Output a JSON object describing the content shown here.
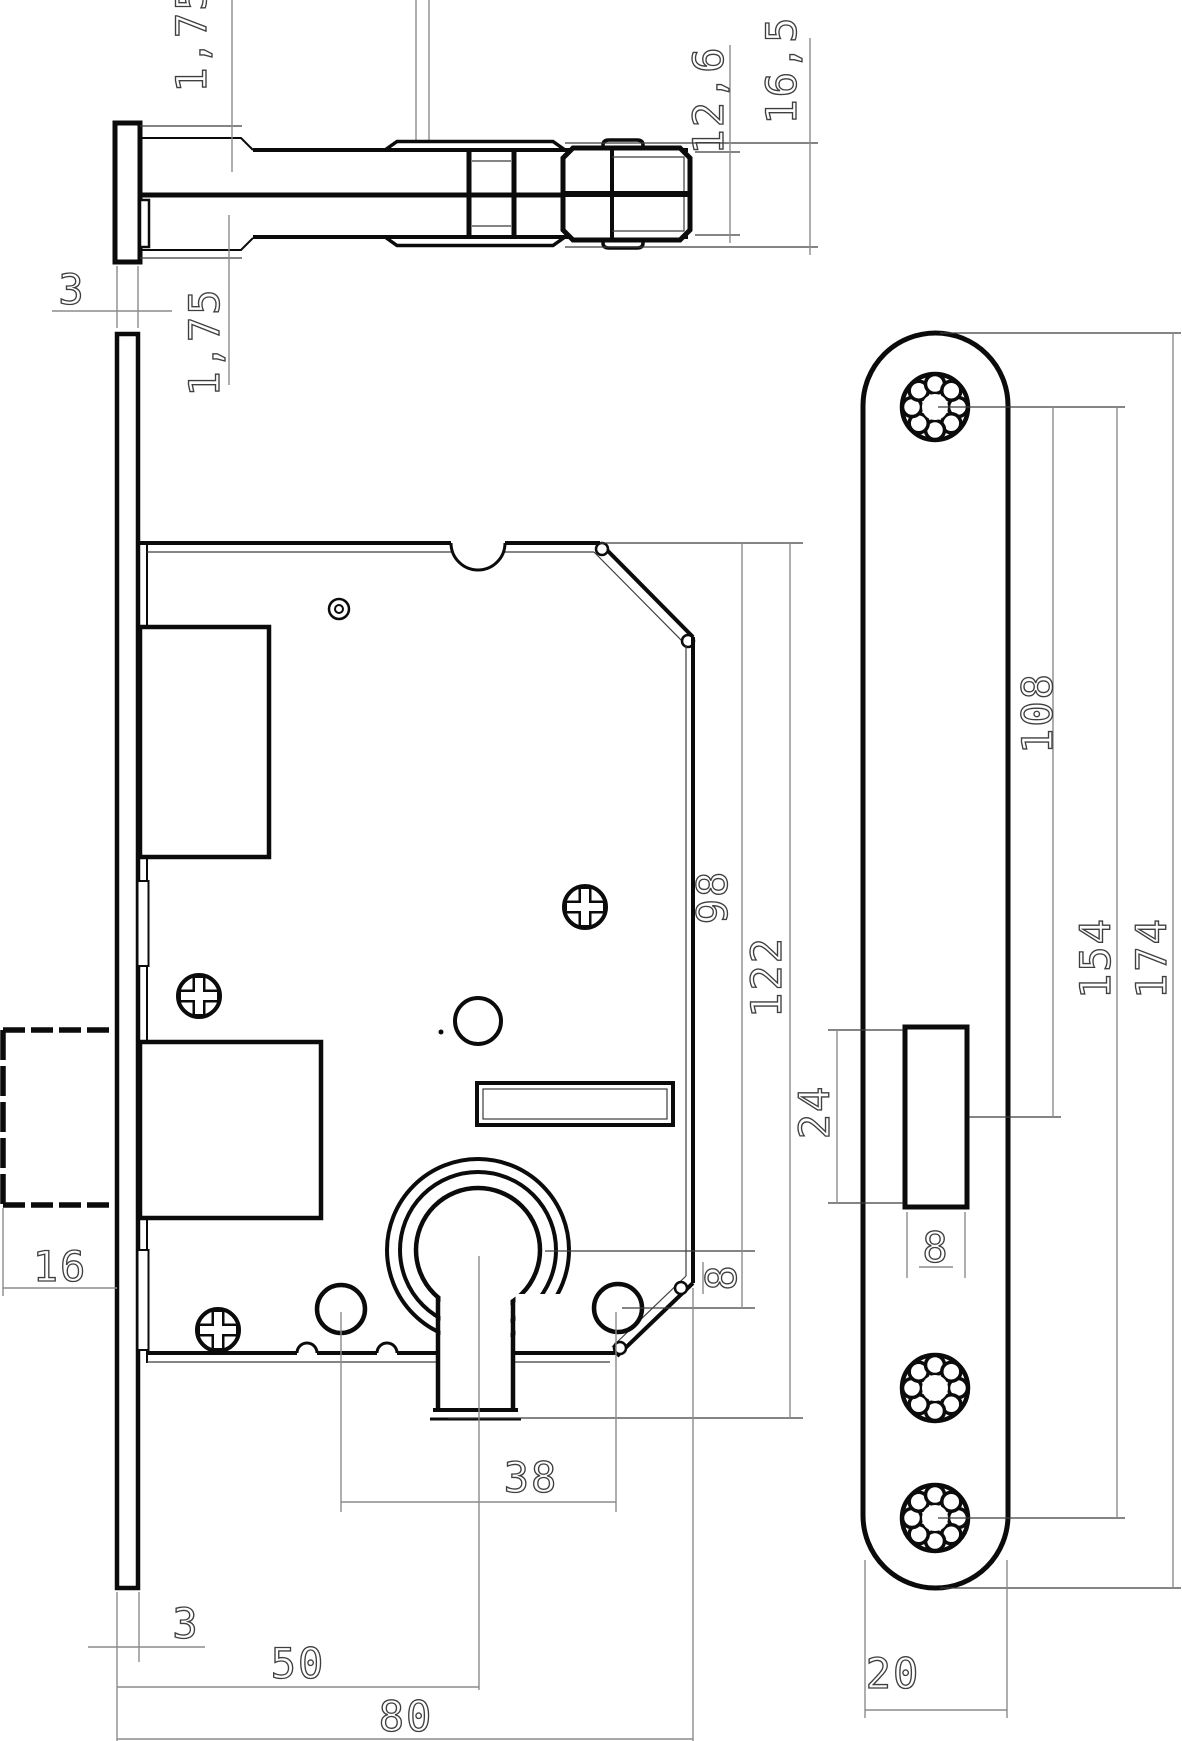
{
  "meta": {
    "drawing_type": "mortise-lock technical drawing",
    "background_color": "#ffffff",
    "line_color": "#0b0b0b",
    "dimension_line_color": "#8c8c8c",
    "dimension_text_color": "#3f3f3f"
  },
  "dims": {
    "latch_plate_thickness_top": "1,75",
    "latch_plate_thickness_bottom": "1,75",
    "latch_bolt_height": "12,6",
    "latch_outer_height": "16,5",
    "faceplate_thickness_top": "3",
    "faceplate_thickness_bottom": "3",
    "deadbolt_throw": "16",
    "backset": "50",
    "case_depth": "80",
    "screw_distance": "38",
    "case_top_to_cylinder": "98",
    "case_top_to_keyway": "122",
    "cylinder_to_screw": "8",
    "plate_top_to_latch": "108",
    "plate_screw_distance": "154",
    "plate_length": "174",
    "latch_window_height": "24",
    "latch_window_width": "8",
    "plate_width": "20"
  }
}
